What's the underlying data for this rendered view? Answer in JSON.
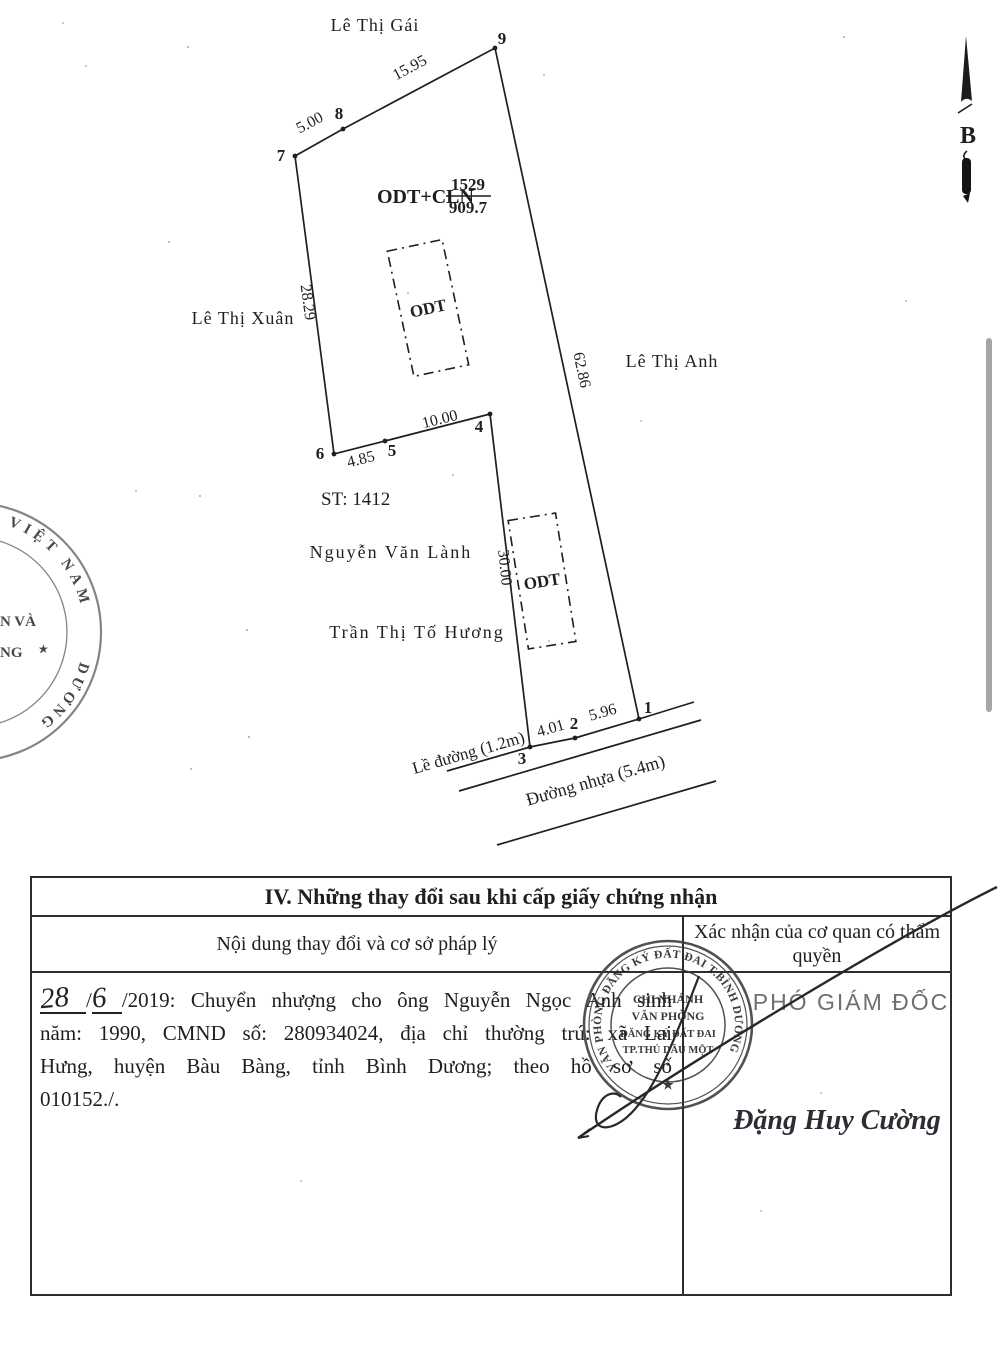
{
  "colors": {
    "ink": "#1f1f1f",
    "stamp_ink": "#3a3a3a",
    "seal_ink": "#6a6a6a",
    "scrollbar": "#a6a6a6",
    "paper": "#ffffff"
  },
  "compass": {
    "label": "B"
  },
  "diagram": {
    "neighbor_top": "Lê Thị Gái",
    "neighbor_left": "Lê Thị Xuân",
    "neighbor_right": "Lê Thị Anh",
    "neighbor_bottom1": "Nguyễn Văn Lành",
    "neighbor_bottom2": "Trần Thị Tố Hương",
    "parcel_code": "ODT+CLN",
    "parcel_number": "1529",
    "parcel_area": "909.7",
    "sheet": "ST: 1412",
    "land_use_box": "ODT",
    "vertices": [
      "1",
      "2",
      "3",
      "4",
      "5",
      "6",
      "7",
      "8",
      "9"
    ],
    "edges": {
      "e78": "5.00",
      "e89": "15.95",
      "e76": "28.29",
      "e65": "4.85",
      "e54": "10.00",
      "e91": "62.86",
      "e43": "30.00",
      "e32": "4.01",
      "e21": "5.96"
    },
    "sidewalk_label": "Lề đường (1.2m)",
    "road_label": "Đường nhựa (5.4m)"
  },
  "left_seal": {
    "arc_top": "VIỆT NAM",
    "fragment1": "N VÀ",
    "fragment2": "NG",
    "arc_bottom": "DƯƠNG",
    "star": "★"
  },
  "table": {
    "section_title": "IV. Những thay đổi sau khi cấp giấy chứng nhận",
    "col_left_header": "Nội dung thay đổi và cơ sở pháp lý",
    "col_right_header": "Xác nhận của cơ quan có thẩm quyền",
    "entry": {
      "day": "28",
      "sep1": "/",
      "month": "6",
      "line1": "/2019: Chuyển nhượng cho ông Nguyễn Ngọc Anh sinh",
      "line2": "năm: 1990, CMND số: 280934024, địa chỉ thường trú: xã Lai",
      "line3": "Hưng, huyện Bàu Bàng, tỉnh Bình Dương; theo hồ sơ số",
      "line4": "010152./."
    },
    "approver_title": "PHÓ GIÁM ĐỐC",
    "approver_name": "Đặng Huy Cường"
  },
  "stamp": {
    "ring": "VĂN PHÒNG ĐĂNG KÝ ĐẤT ĐAI T.BÌNH DƯƠNG",
    "line1": "CHI NHÁNH",
    "line2": "VĂN PHÒNG",
    "line3": "ĐĂNG KÝ ĐẤT ĐAI",
    "line4": "TP.THỦ DẦU MỘT",
    "dot": "•",
    "star": "★"
  }
}
